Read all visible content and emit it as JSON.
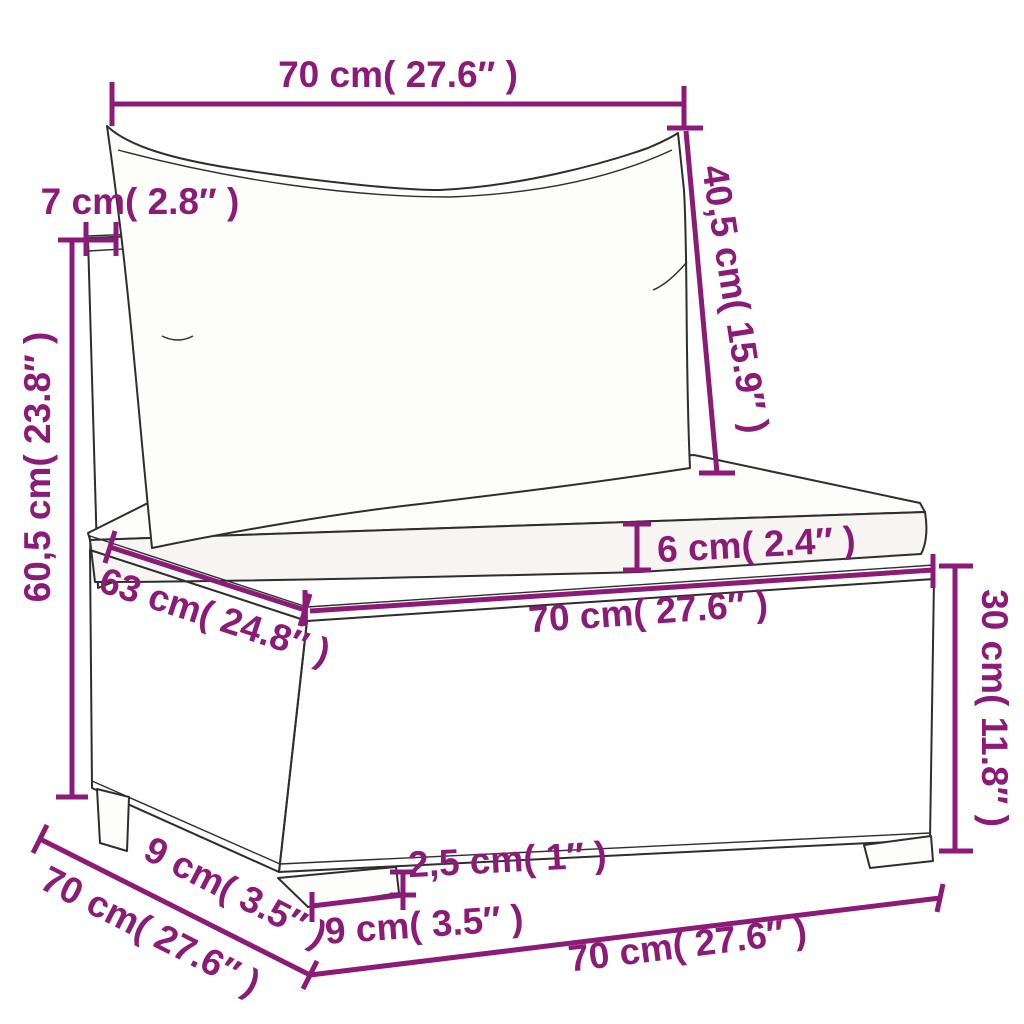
{
  "title": "Garden sofa middle section — dimension diagram",
  "accent_color": "#8C1B78",
  "sketch_color": "#2E2E2E",
  "dimensions": {
    "top_width": "70 cm( 27.6″ )",
    "back_cushion_height": "40,5 cm( 15.9″ )",
    "back_thickness": "7 cm( 2.8″ )",
    "total_height": "60,5 cm( 23.8″ )",
    "seat_cushion_thickness": "6 cm( 2.4″ )",
    "seat_width": "70 cm( 27.6″ )",
    "seat_depth": "63 cm( 24.8″ )",
    "base_height": "30 cm( 11.8″ )",
    "foot_height": "2,5 cm( 1″ )",
    "foot_width": "9 cm( 3.5″ )",
    "side_foot_depth": "9 cm( 3.5″ )",
    "side_depth": "70 cm( 27.6″ )",
    "bottom_width": "70 cm( 27.6″ )"
  }
}
